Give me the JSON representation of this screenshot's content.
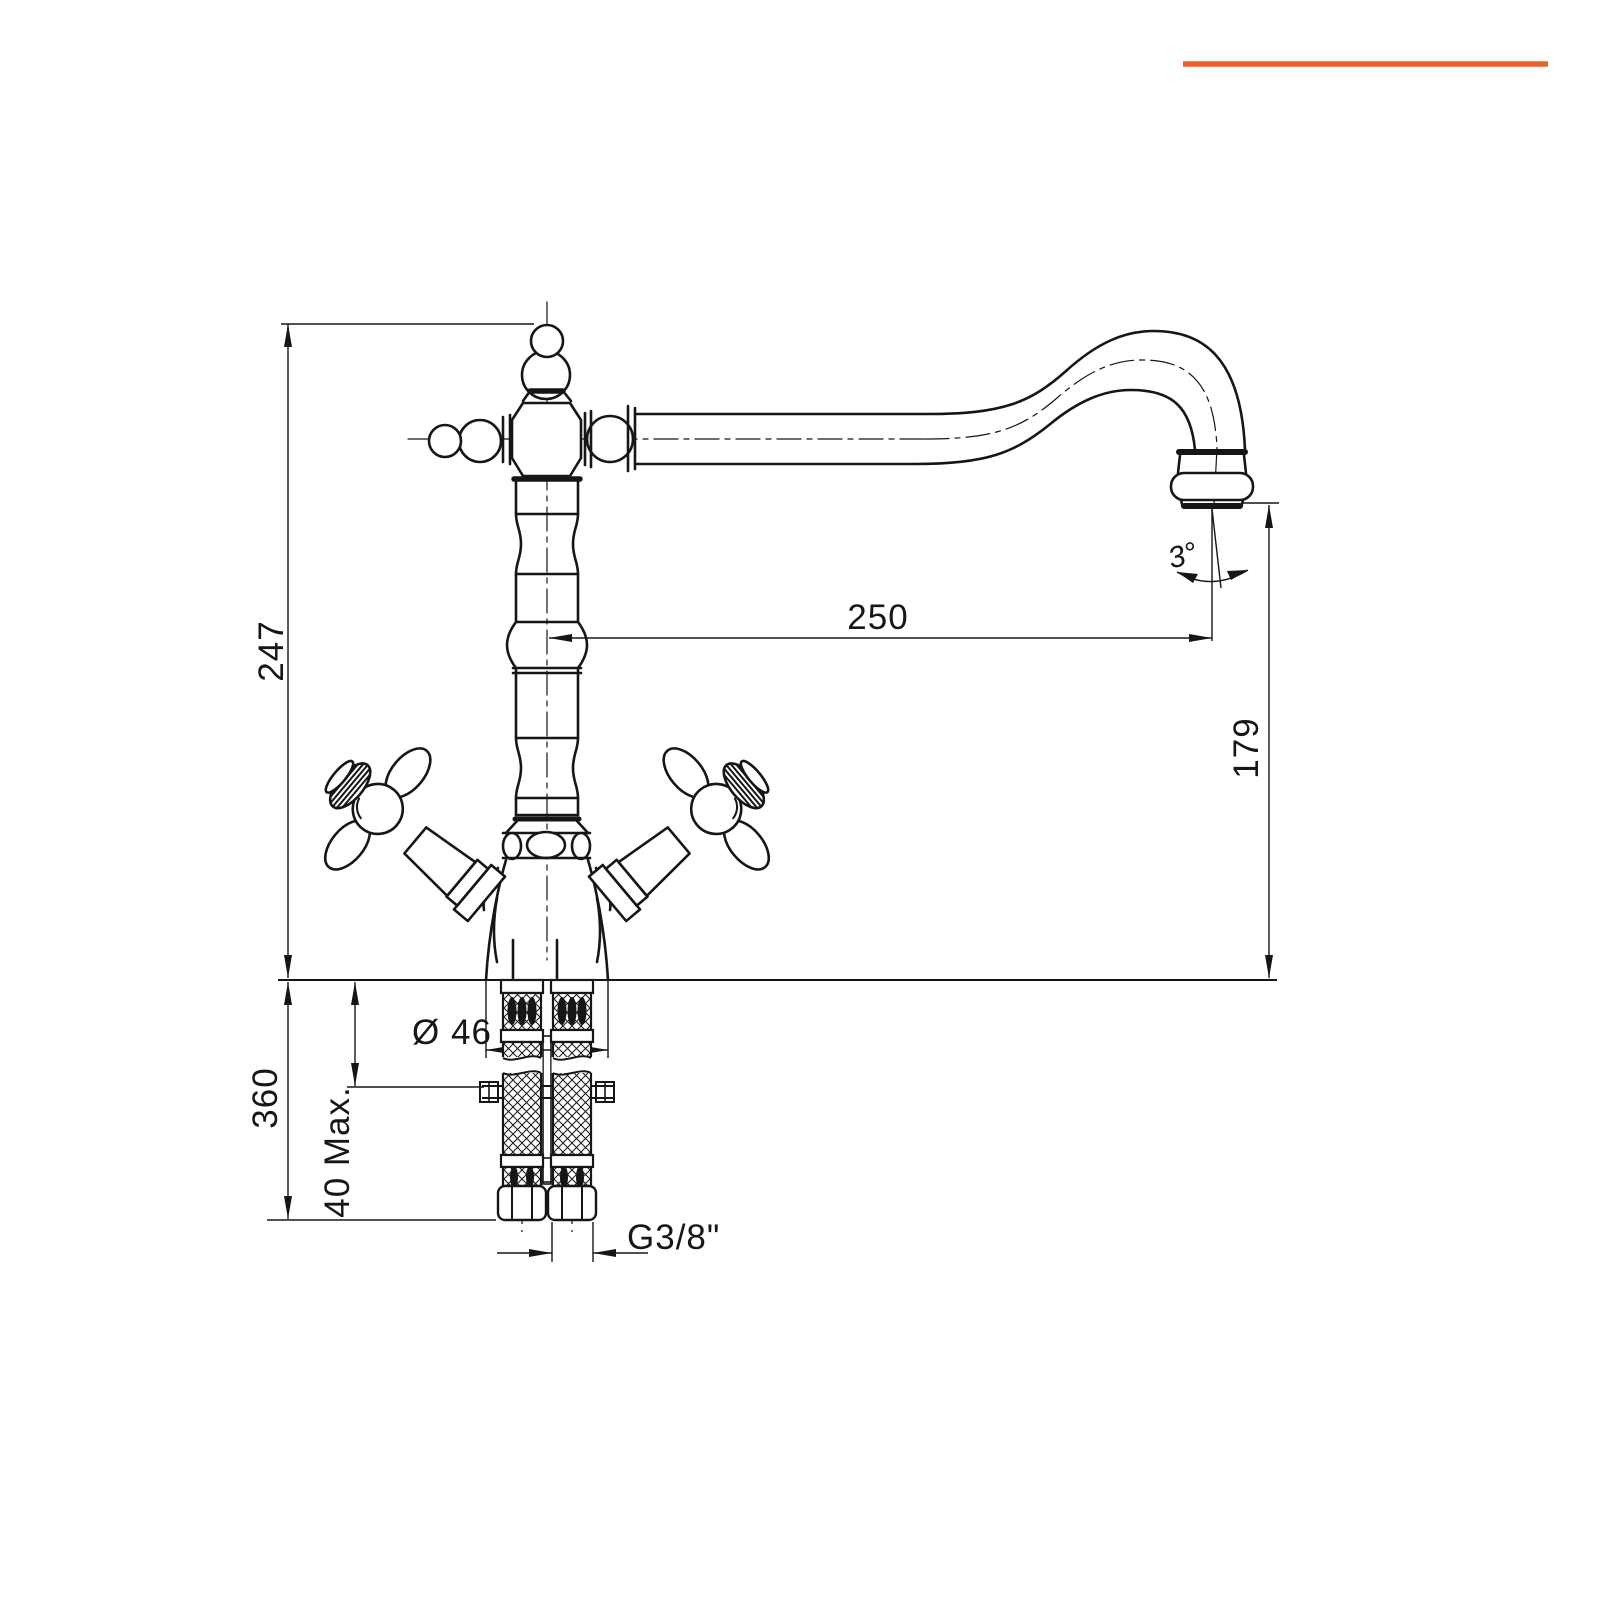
{
  "page": {
    "background_color": "#ffffff",
    "line_color": "#161616",
    "accent_bar_color": "#F0602C"
  },
  "drawing": {
    "type": "technical-dimension-drawing",
    "subject": "classic two-cross-handle single-hole kitchen mixer tap with swivel spout, front elevation with flexible supply hoses",
    "labels": {
      "overall_height": "247",
      "spout_reach": "250",
      "spout_outlet_height": "179",
      "hose_length": "360",
      "deck_thickness_max": "40 Max.",
      "base_diameter": "Ø 46",
      "supply_thread": "G3/8\"",
      "outlet_angle": "3°"
    }
  }
}
